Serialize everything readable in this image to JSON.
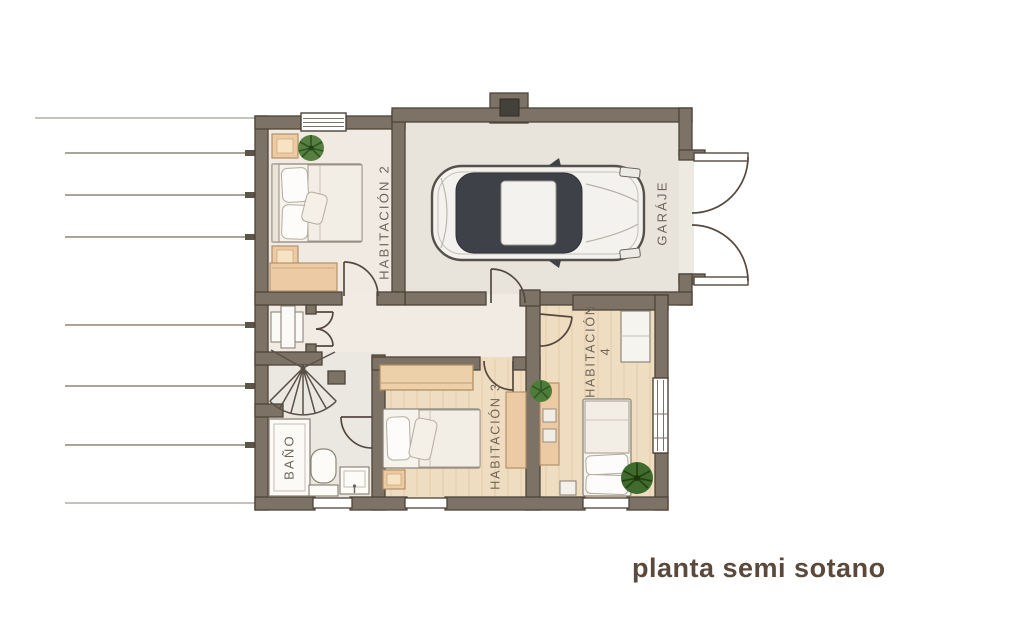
{
  "title": "planta semi sotano",
  "rooms": [
    {
      "id": "habitacion-2",
      "label": "HABITACIÓN 2"
    },
    {
      "id": "garaje",
      "label": "GARÁJE"
    },
    {
      "id": "habitacion-3",
      "label": "HABITACIÓN 3"
    },
    {
      "id": "habitacion-4",
      "label": "HABITACIÓN",
      "number": "4"
    },
    {
      "id": "bano",
      "label": "BAÑO"
    }
  ],
  "colors": {
    "wall_fill": "#7d7266",
    "wall_outline": "#4d4338",
    "floor_cream": "#f1ebe3",
    "floor_garage": "#e8e4db",
    "floor_wood": "#efddc1",
    "floor_gray": "#ebe8e1",
    "furniture_wood": "#eccba4",
    "linen_white": "#f6f3ed",
    "plant_green": "#4e7c39",
    "label_text": "#6e6558",
    "title_text": "#5b4a3b",
    "car_glass": "#3e4147",
    "car_body": "#f3f2ef"
  }
}
